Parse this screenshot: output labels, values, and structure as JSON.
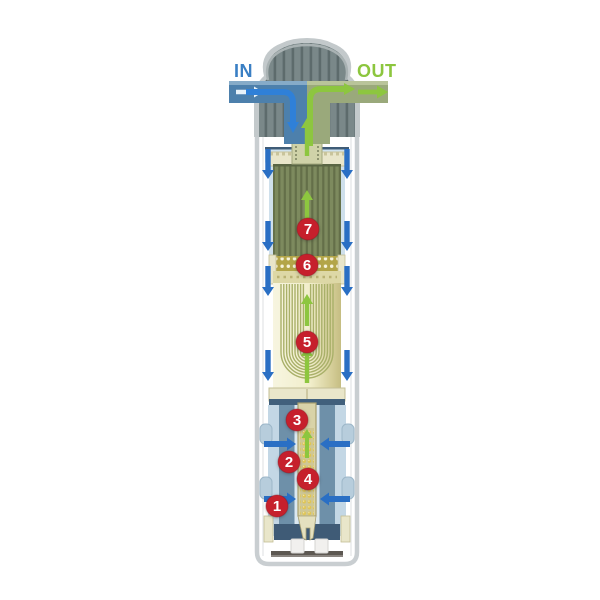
{
  "labels": {
    "in": "IN",
    "out": "OUT"
  },
  "markers": [
    {
      "number": "1"
    },
    {
      "number": "2"
    },
    {
      "number": "3"
    },
    {
      "number": "4"
    },
    {
      "number": "5"
    },
    {
      "number": "6"
    },
    {
      "number": "7"
    }
  ],
  "colors": {
    "in_label": "#3a7fc4",
    "out_label": "#8cc63e",
    "marker_red": "#c6202c",
    "flow_blue": "#2a6fc4",
    "flow_green": "#8dc63f",
    "pipe_blue": "#4d80ac",
    "pipe_olive": "#9aa97b",
    "cap_gray": "#7a8889",
    "housing_border": "#c9ced1",
    "carbon_olive": "#7d8a5e",
    "gold_band": "#b3a548",
    "membrane_cream": "#f3f0d4",
    "shell_blue": "#6e90a9",
    "tray_blue": "#cfe2ee",
    "navy": "#3f5c77"
  }
}
